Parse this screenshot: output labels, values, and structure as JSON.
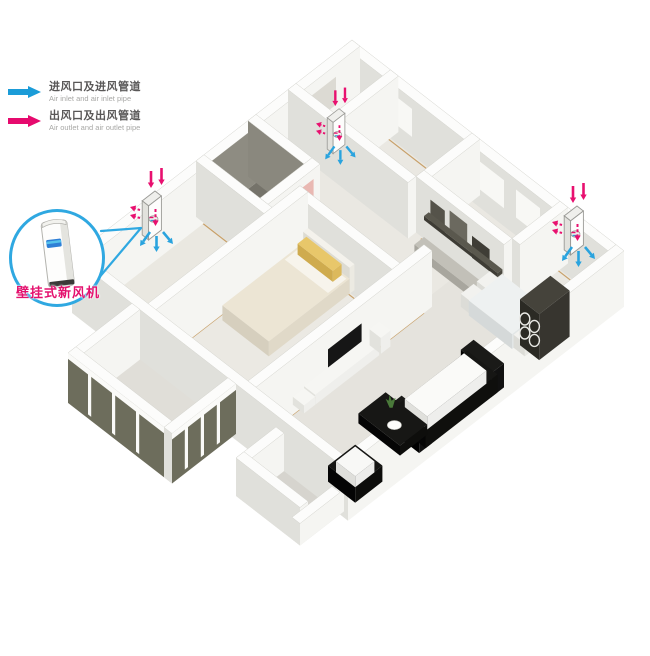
{
  "legend": {
    "items": [
      {
        "id": "air-inlet",
        "label": "进风口及进风管道",
        "sublabel": "Air inlet and air inlet pipe",
        "color": "#1b9cd8"
      },
      {
        "id": "air-outlet",
        "label": "出风口及出风管道",
        "sublabel": "Air outlet and air outlet pipe",
        "color": "#e60a6e"
      }
    ]
  },
  "callout": {
    "label": "壁挂式新风机",
    "circle_color": "#2fa8e1",
    "label_color": "#e4116e"
  },
  "devices": [
    {
      "id": "fresh-air-unit-left-bedroom"
    },
    {
      "id": "fresh-air-unit-back-bedroom"
    },
    {
      "id": "fresh-air-unit-dining-room"
    }
  ],
  "colors": {
    "inlet_blue": "#29a3de",
    "outlet_pink": "#e8106f",
    "callout_blue": "#2fa8e1",
    "wall_face": "#f5f5f2",
    "wall_shade": "#e0e0db",
    "wall_top": "#fcfcfb",
    "floor": "#eae8e2",
    "floor_living": "#e5e3dd",
    "floor_dark": "#75736a",
    "skirting": "#c8a069",
    "glass": "#6d6d5c",
    "background": "#ffffff"
  }
}
